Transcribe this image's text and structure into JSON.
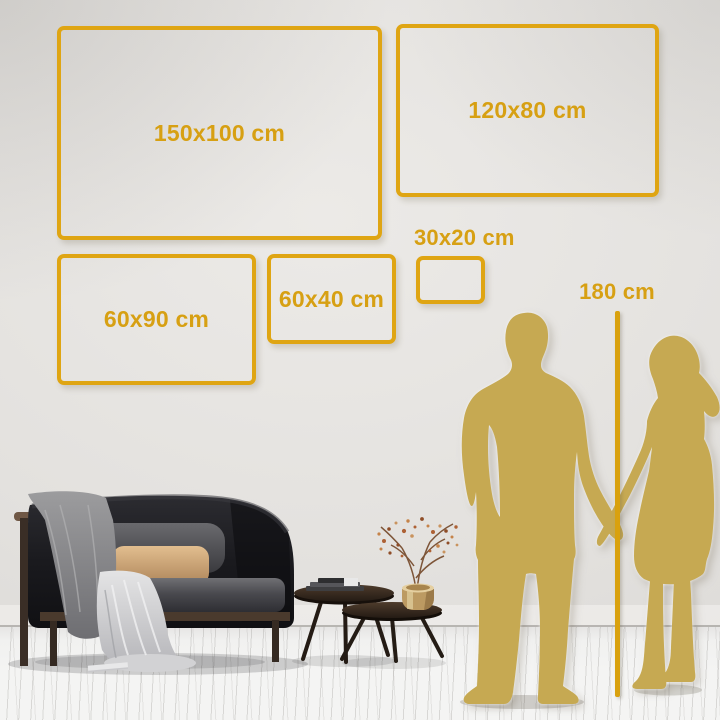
{
  "size_guide": {
    "frames": [
      {
        "label": "150x100 cm",
        "dimensions_cm": [
          150,
          100
        ]
      },
      {
        "label": "120x80 cm",
        "dimensions_cm": [
          120,
          80
        ]
      },
      {
        "label": "60x90 cm",
        "dimensions_cm": [
          60,
          90
        ]
      },
      {
        "label": "60x40 cm",
        "dimensions_cm": [
          60,
          40
        ]
      },
      {
        "label": "30x20 cm",
        "dimensions_cm": [
          30,
          20
        ]
      }
    ],
    "height_reference": {
      "label": "180 cm",
      "value_cm": 180
    }
  },
  "colors": {
    "frame_gold": "#DFA513",
    "label_gold": "#D7A013",
    "silhouette_gold": "#C6A952",
    "ruler_gold": "#D9A10E",
    "wall_light": "#ECEAE7",
    "wall_dark": "#DAD8D5",
    "floor": "#F4F4F3"
  },
  "scene": {
    "elements": [
      "man-silhouette",
      "woman-silhouette",
      "height-ruler-line",
      "sofa-illustration",
      "coffee-tables-illustration",
      "plant-illustration"
    ]
  }
}
